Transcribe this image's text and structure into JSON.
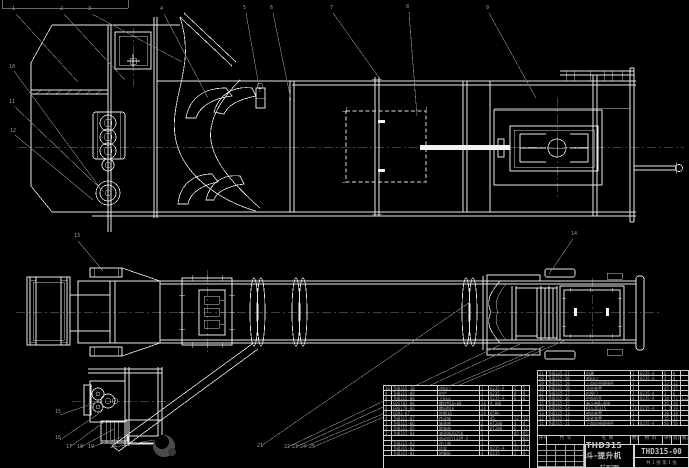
{
  "colors": {
    "background": "#000000",
    "linework": "#e8e8e8",
    "dim_lines": "#8a8a8a",
    "table_text": "#a9a9a9"
  },
  "title_block": {
    "drawing_title_line1": "THD315斗-提升机",
    "drawing_title_line2": "装配图",
    "drawing_number": "THD315-00",
    "sheet_note": "共 1 张  第 1 张"
  },
  "bom_right": {
    "headers": [
      "序号",
      "代  号",
      "名  称",
      "数量",
      "材 料",
      "单件",
      "总计",
      "备注"
    ],
    "rows": [
      [
        "21",
        "THD315-21",
        "机罩",
        "1",
        "Q235-A",
        "6",
        "6",
        ""
      ],
      [
        "20",
        "THD315-20",
        "卸料口",
        "1",
        "Q235-A",
        "4",
        "4",
        ""
      ],
      [
        "19",
        "THD315-19",
        "上部机壳焊接件",
        "1",
        "",
        "32",
        "32",
        ""
      ],
      [
        "18",
        "THD315-18",
        "头轮装置",
        "1",
        "",
        "45",
        "45",
        ""
      ],
      [
        "17",
        "THD315-17",
        "检视门",
        "2",
        "Q235-A",
        "3",
        "6",
        ""
      ],
      [
        "16",
        "THD315-16",
        "中部机壳",
        "4",
        "Q235-A",
        "18",
        "72",
        "L=2m"
      ],
      [
        "15",
        "THD315-15",
        "畚斗带B=400",
        "1",
        "",
        "26",
        "26",
        ""
      ],
      [
        "14",
        "THD315-14",
        "料斗ZD315",
        "24",
        "Q235-A",
        "1.2",
        "29",
        ""
      ],
      [
        "13",
        "THD315-13",
        "底轮装置",
        "1",
        "",
        "38",
        "38",
        ""
      ],
      [
        "12",
        "THD315-12",
        "张紧装置",
        "1",
        "",
        "15",
        "15",
        ""
      ],
      [
        "11",
        "THD315-11",
        "下部机座焊接件",
        "1",
        "Q235-A",
        "56",
        "56",
        ""
      ]
    ]
  },
  "bom_left": {
    "rows": [
      [
        "10",
        "THD315-10",
        "进料口",
        "1",
        "Q235-A",
        "5",
        "5"
      ],
      [
        "9",
        "THD315-09",
        "护栏",
        "1",
        "Q235",
        "8",
        "8"
      ],
      [
        "8",
        "THD315-08",
        "下料斗",
        "1",
        "Q235-A",
        "6",
        "6"
      ],
      [
        "7",
        "GB5782-86",
        "螺栓M16×60",
        "24",
        "4.8级",
        "",
        ""
      ],
      [
        "6",
        "GB6170-86",
        "螺母M16",
        "24",
        "",
        "",
        ""
      ],
      [
        "5",
        "GB93-87",
        "垫圈16",
        "24",
        "65Mn",
        "",
        ""
      ],
      [
        "4",
        "THD315-07",
        "传动轴",
        "1",
        "45",
        "12",
        "12"
      ],
      [
        "3",
        "THD315-06",
        "轴承座",
        "2",
        "HT200",
        "4",
        "8"
      ],
      [
        "2",
        "THD315-05",
        "联轴器",
        "2",
        "HT200",
        "6",
        "12"
      ],
      [
        "1",
        "THD315-04",
        "减速器ZQ250",
        "1",
        "",
        "85",
        "85"
      ],
      [
        "",
        "",
        "电动机Y132M-4",
        "1",
        "",
        "",
        "B3"
      ],
      [
        "",
        "THD315-03",
        "逆止器",
        "1",
        "",
        "3",
        "3"
      ],
      [
        "",
        "THD315-02",
        "机架",
        "1",
        "Q235-A",
        "22",
        "22"
      ],
      [
        "",
        "THD315-01",
        "地脚板",
        "4",
        "Q235",
        "2",
        "8"
      ]
    ]
  },
  "callout_numbers": [
    "1",
    "2",
    "3",
    "4",
    "5",
    "6",
    "7",
    "8",
    "9",
    "10",
    "11",
    "12",
    "13",
    "14",
    "15",
    "16",
    "17",
    "18",
    "19",
    "20",
    "21",
    "22",
    "23",
    "24",
    "25"
  ]
}
